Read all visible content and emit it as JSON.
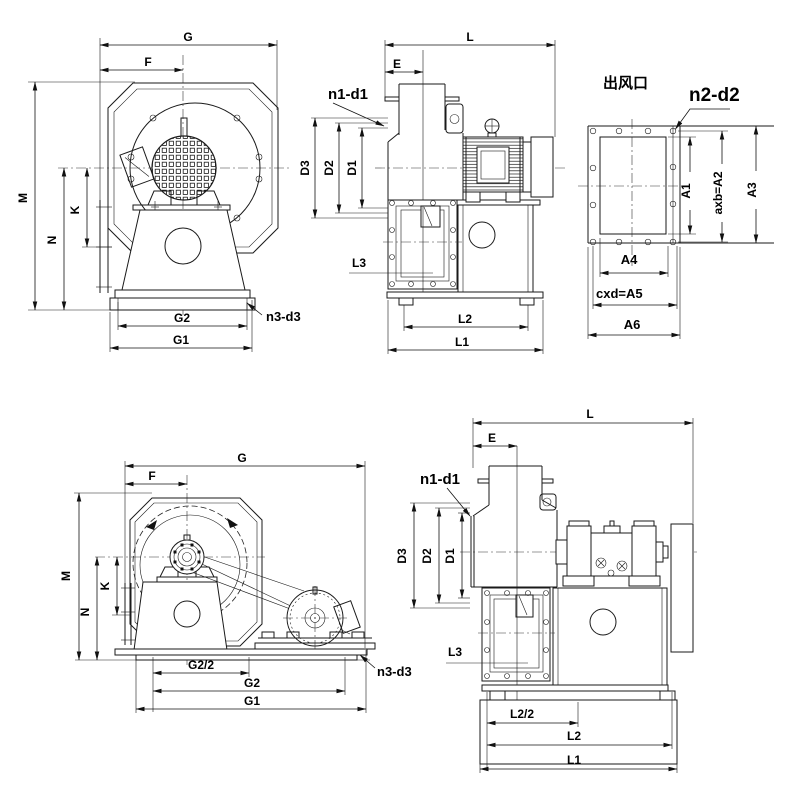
{
  "drawings": {
    "top_front": {
      "labels": {
        "G": "G",
        "F": "F",
        "M": "M",
        "K": "K",
        "N": "N",
        "G2": "G2",
        "G1": "G1",
        "n3_d3": "n3-d3"
      }
    },
    "top_side": {
      "labels": {
        "L": "L",
        "E": "E",
        "n1_d1": "n1-d1",
        "D3": "D3",
        "D2": "D2",
        "D1": "D1",
        "L3": "L3",
        "L2": "L2",
        "L1": "L1"
      }
    },
    "outlet_flange": {
      "title": "出风口",
      "labels": {
        "n2_d2": "n2-d2",
        "A1": "A1",
        "A2": "axb=A2",
        "A3": "A3",
        "A4": "A4",
        "A5": "cxd=A5",
        "A6": "A6"
      }
    },
    "bottom_front": {
      "labels": {
        "G": "G",
        "F": "F",
        "M": "M",
        "K": "K",
        "N": "N",
        "G2_half": "G2/2",
        "G2": "G2",
        "G1": "G1",
        "n3_d3": "n3-d3"
      }
    },
    "bottom_side": {
      "labels": {
        "L": "L",
        "E": "E",
        "n1_d1": "n1-d1",
        "D3": "D3",
        "D2": "D2",
        "D1": "D1",
        "L3": "L3",
        "L2_half": "L2/2",
        "L2": "L2",
        "L1": "L1"
      }
    }
  }
}
